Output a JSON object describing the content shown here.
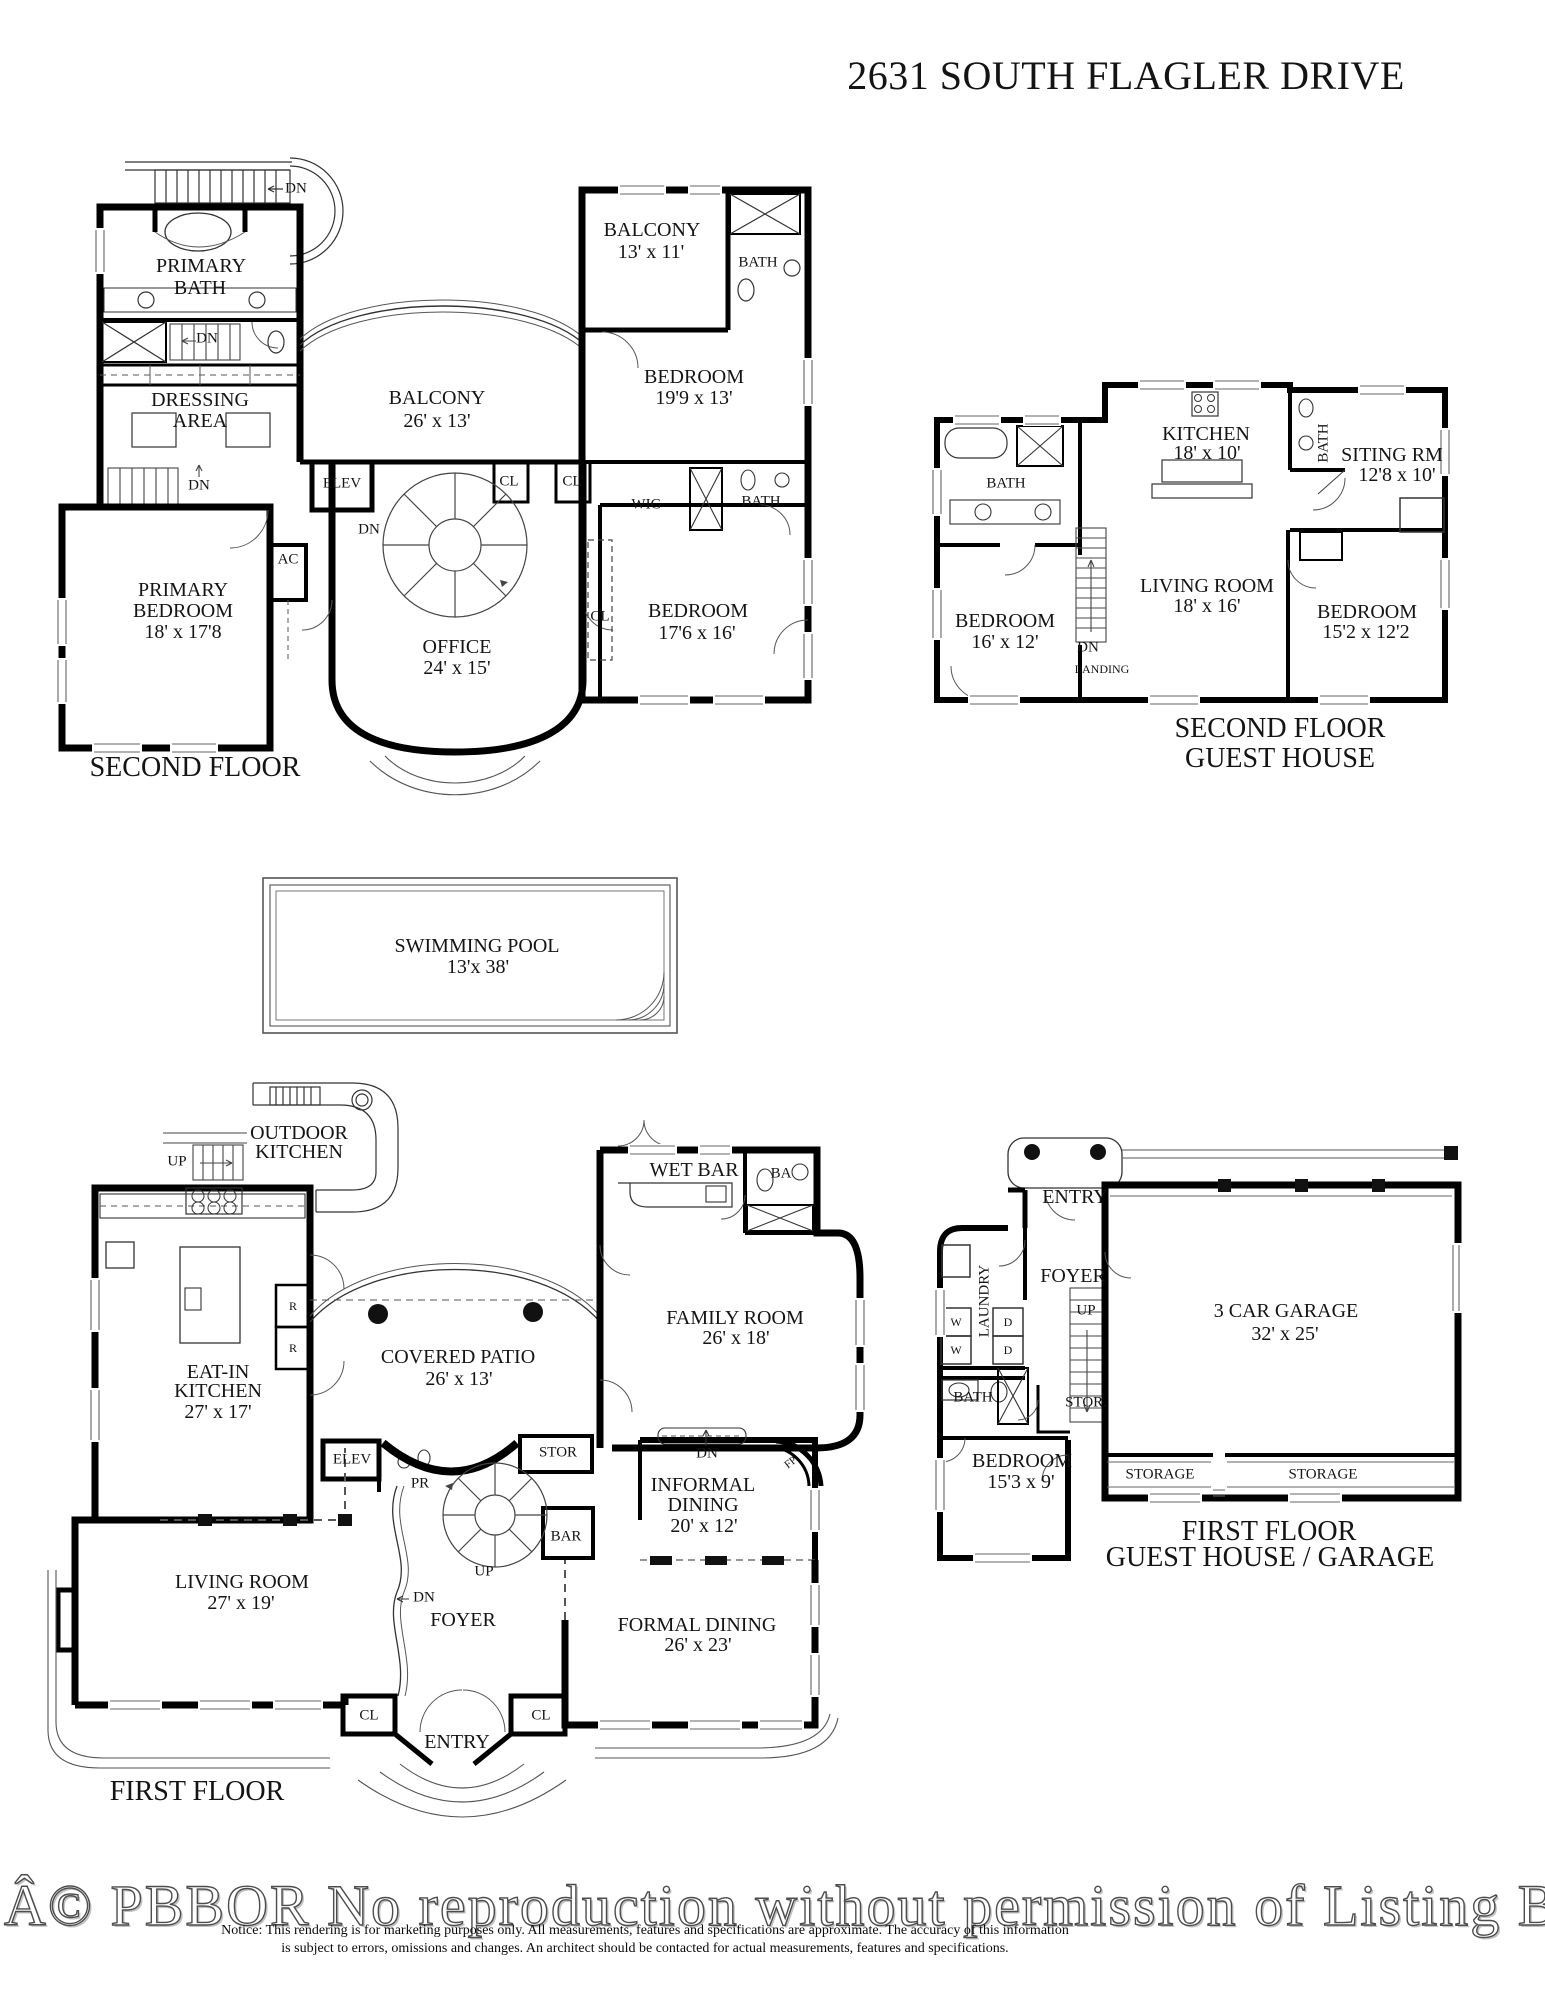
{
  "title": "2631 SOUTH FLAGLER DRIVE",
  "second_floor": {
    "floor_label": "SECOND FLOOR",
    "stair_dn_top": "DN",
    "stair_dn_mid": "DN",
    "stair_dn_low": "DN",
    "spiral_dn": "DN",
    "primary_bath": {
      "l1": "PRIMARY",
      "l2": "BATH"
    },
    "dressing": {
      "l1": "DRESSING",
      "l2": "AREA"
    },
    "primary_bedroom": {
      "l1": "PRIMARY",
      "l2": "BEDROOM",
      "dims": "18' x 17'8"
    },
    "ac": "AC",
    "elev": "ELEV",
    "cl1": "CL",
    "cl2": "CL",
    "cl3": "CL",
    "wic": "WIC",
    "bath_hall": "BATH",
    "balcony_center": {
      "l1": "BALCONY",
      "dims": "26' x 13'"
    },
    "balcony_right": {
      "l1": "BALCONY",
      "dims": "13' x 11'"
    },
    "bath_right": "BATH",
    "bedroom_ne": {
      "l1": "BEDROOM",
      "dims": "19'9 x 13'"
    },
    "office": {
      "l1": "OFFICE",
      "dims": "24' x 15'"
    },
    "bedroom_se": {
      "l1": "BEDROOM",
      "dims": "17'6 x 16'"
    }
  },
  "guest_second": {
    "floor_label_1": "SECOND FLOOR",
    "floor_label_2": "GUEST HOUSE",
    "bath_left": "BATH",
    "bath_small": "BATH",
    "kitchen": {
      "l1": "KITCHEN",
      "dims": "18' x 10'"
    },
    "siting": {
      "l1": "SITING RM",
      "dims": "12'8 x 10'"
    },
    "bedroom_left": {
      "l1": "BEDROOM",
      "dims": "16' x 12'"
    },
    "living": {
      "l1": "LIVING ROOM",
      "dims": "18' x 16'"
    },
    "bedroom_right": {
      "l1": "BEDROOM",
      "dims": "15'2 x 12'2"
    },
    "dn": "DN",
    "landing": "LANDING"
  },
  "pool": {
    "l1": "SWIMMING POOL",
    "dims": "13'x 38'"
  },
  "first_floor": {
    "floor_label": "FIRST FLOOR",
    "outdoor_kitchen": {
      "l1": "OUTDOOR",
      "l2": "KITCHEN"
    },
    "up_stair": "UP",
    "up_spiral": "UP",
    "dn_foyer": "DN",
    "dn_informal": "DN",
    "eat_in": {
      "l1": "EAT-IN",
      "l2": "KITCHEN",
      "dims": "27' x 17'"
    },
    "r1": "R",
    "r2": "R",
    "covered_patio": {
      "l1": "COVERED PATIO",
      "dims": "26' x 13'"
    },
    "wet_bar": "WET BAR",
    "ba": "BA",
    "family": {
      "l1": "FAMILY ROOM",
      "dims": "26' x 18'"
    },
    "elev": "ELEV",
    "pr": "PR",
    "stor": "STOR",
    "bar": "BAR",
    "fp": "FP",
    "foyer": "FOYER",
    "informal": {
      "l1": "INFORMAL",
      "l2": "DINING",
      "dims": "20' x 12'"
    },
    "formal": {
      "l1": "FORMAL DINING",
      "dims": "26' x 23'"
    },
    "living": {
      "l1": "LIVING ROOM",
      "dims": "27' x 19'"
    },
    "cl1": "CL",
    "cl2": "CL",
    "entry": "ENTRY"
  },
  "guest_first": {
    "floor_label_1": "FIRST FLOOR",
    "floor_label_2": "GUEST HOUSE / GARAGE",
    "entry": "ENTRY",
    "foyer": "FOYER",
    "laundry": "LAUNDRY",
    "w1": "W",
    "w2": "W",
    "d1": "D",
    "d2": "D",
    "up": "UP",
    "bath": "BATH",
    "stor": "STOR.",
    "bedroom": {
      "l1": "BEDROOM",
      "dims": "15'3 x 9'"
    },
    "garage": {
      "l1": "3 CAR GARAGE",
      "dims": "32' x 25'"
    },
    "storage1": "STORAGE",
    "storage2": "STORAGE"
  },
  "watermark": "Â© PBBOR No reproduction without permission of Listing Brok",
  "notice": {
    "line1": "Notice: This rendering is for marketing purposes only. All measurements, features and specifications are approximate. The accuracy of this information",
    "line2": "is subject to errors, omissions and changes. An architect should be contacted for actual measurements, features and specifications."
  }
}
